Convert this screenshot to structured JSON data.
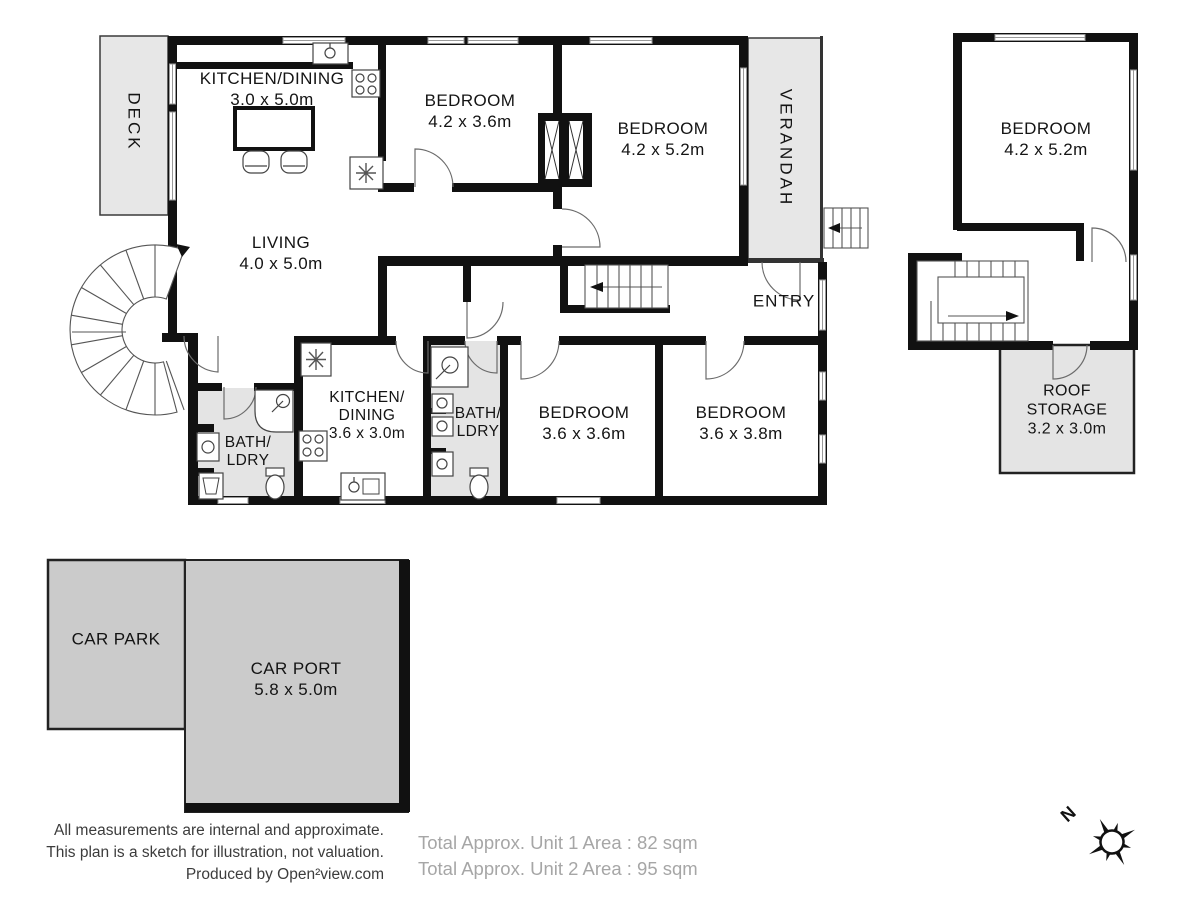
{
  "plan": {
    "rooms": [
      {
        "id": "deck",
        "lines": [
          "DECK"
        ]
      },
      {
        "id": "kitchen-dining-1",
        "lines": [
          "KITCHEN/DINING",
          "3.0 x 5.0m"
        ]
      },
      {
        "id": "living",
        "lines": [
          "LIVING",
          "4.0 x 5.0m"
        ]
      },
      {
        "id": "bedroom-1",
        "lines": [
          "BEDROOM",
          "4.2 x 3.6m"
        ]
      },
      {
        "id": "bedroom-2",
        "lines": [
          "BEDROOM",
          "4.2 x 5.2m"
        ]
      },
      {
        "id": "verandah",
        "lines": [
          "VERANDAH"
        ]
      },
      {
        "id": "entry",
        "lines": [
          "ENTRY"
        ]
      },
      {
        "id": "kitchen-dining-2",
        "lines": [
          "KITCHEN/",
          "DINING",
          "3.6 x 3.0m"
        ]
      },
      {
        "id": "bath-ldry-1",
        "lines": [
          "BATH/",
          "LDRY"
        ]
      },
      {
        "id": "bath-ldry-2",
        "lines": [
          "BATH/",
          "LDRY"
        ]
      },
      {
        "id": "bedroom-3",
        "lines": [
          "BEDROOM",
          "3.6 x 3.6m"
        ]
      },
      {
        "id": "bedroom-4",
        "lines": [
          "BEDROOM",
          "3.6 x 3.8m"
        ]
      },
      {
        "id": "bedroom-5",
        "lines": [
          "BEDROOM",
          "4.2 x 5.2m"
        ]
      },
      {
        "id": "roof-storage",
        "lines": [
          "ROOF",
          "STORAGE",
          "3.2 x 3.0m"
        ]
      },
      {
        "id": "car-park",
        "lines": [
          "CAR PARK"
        ]
      },
      {
        "id": "car-port",
        "lines": [
          "CAR PORT",
          "5.8 x 5.0m"
        ]
      }
    ],
    "compass": {
      "north_label": "N"
    }
  },
  "footer": {
    "disclaimer_lines": [
      "All measurements are internal and approximate.",
      "This plan is a sketch for illustration, not valuation.",
      "Produced by Open²view.com"
    ],
    "totals": [
      "Total Approx. Unit 1 Area : 82 sqm",
      "Total Approx. Unit 2 Area : 95 sqm"
    ]
  },
  "colors": {
    "wall": "#111111",
    "area_light": "#e7e7e7",
    "area_mid": "#cbcbcb",
    "door_line": "#666666",
    "footer_dark": "#3c3c3c",
    "footer_light": "#a6a6a6"
  }
}
